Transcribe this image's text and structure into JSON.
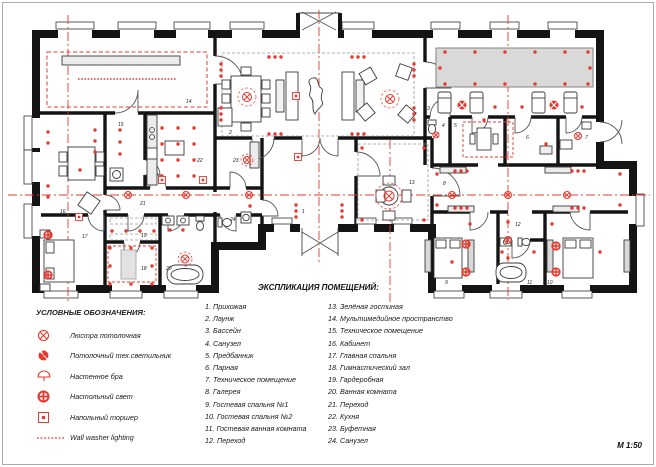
{
  "plan": {
    "scale_label": "М 1:50",
    "colors": {
      "accent_red": "#e8392e",
      "wall_black": "#141414",
      "pool_gray": "#d9d9d9"
    }
  },
  "legend": {
    "title": "УСЛОВНЫЕ ОБОЗНАЧЕНИЯ:",
    "items": [
      {
        "icon": "ceiling-chandelier-icon",
        "label": "Люстра потолочная"
      },
      {
        "icon": "ceiling-tech-light-icon",
        "label": "Потолочный тех.светильник"
      },
      {
        "icon": "wall-sconce-icon",
        "label": "Настенное бра"
      },
      {
        "icon": "table-light-icon",
        "label": "Настольный свет"
      },
      {
        "icon": "floor-lamp-icon",
        "label": "Напольный торшер"
      },
      {
        "icon": "wall-washer-icon",
        "label": "Wall washer lighting"
      }
    ]
  },
  "explication": {
    "title": "ЭКСПЛИКАЦИЯ ПОМЕЩЕНИЙ:",
    "items": [
      {
        "n": "1",
        "name": "Прихожая"
      },
      {
        "n": "2",
        "name": "Лаунж"
      },
      {
        "n": "3",
        "name": "Бассейн"
      },
      {
        "n": "4",
        "name": "Санузел"
      },
      {
        "n": "5",
        "name": "Предбанник"
      },
      {
        "n": "6",
        "name": "Парная"
      },
      {
        "n": "7",
        "name": "Техническое помещение"
      },
      {
        "n": "8",
        "name": "Галерея"
      },
      {
        "n": "9",
        "name": "Гостевая спальня №1"
      },
      {
        "n": "10",
        "name": "Гостевая спальня №2"
      },
      {
        "n": "11",
        "name": "Гостевая ванная комната"
      },
      {
        "n": "12",
        "name": "Переход"
      },
      {
        "n": "13",
        "name": "Зелёная гостиная"
      },
      {
        "n": "14",
        "name": "Мультимедийное пространство"
      },
      {
        "n": "15",
        "name": "Техническое помещение"
      },
      {
        "n": "16",
        "name": "Кабинет"
      },
      {
        "n": "17",
        "name": "Главная спальня"
      },
      {
        "n": "18",
        "name": "Гимнастический зал"
      },
      {
        "n": "19",
        "name": "Гардеробная"
      },
      {
        "n": "20",
        "name": "Ванная комната"
      },
      {
        "n": "21",
        "name": "Переход"
      },
      {
        "n": "22",
        "name": "Кухня"
      },
      {
        "n": "23",
        "name": "Буфетная"
      },
      {
        "n": "24",
        "name": "Санузел"
      }
    ]
  }
}
